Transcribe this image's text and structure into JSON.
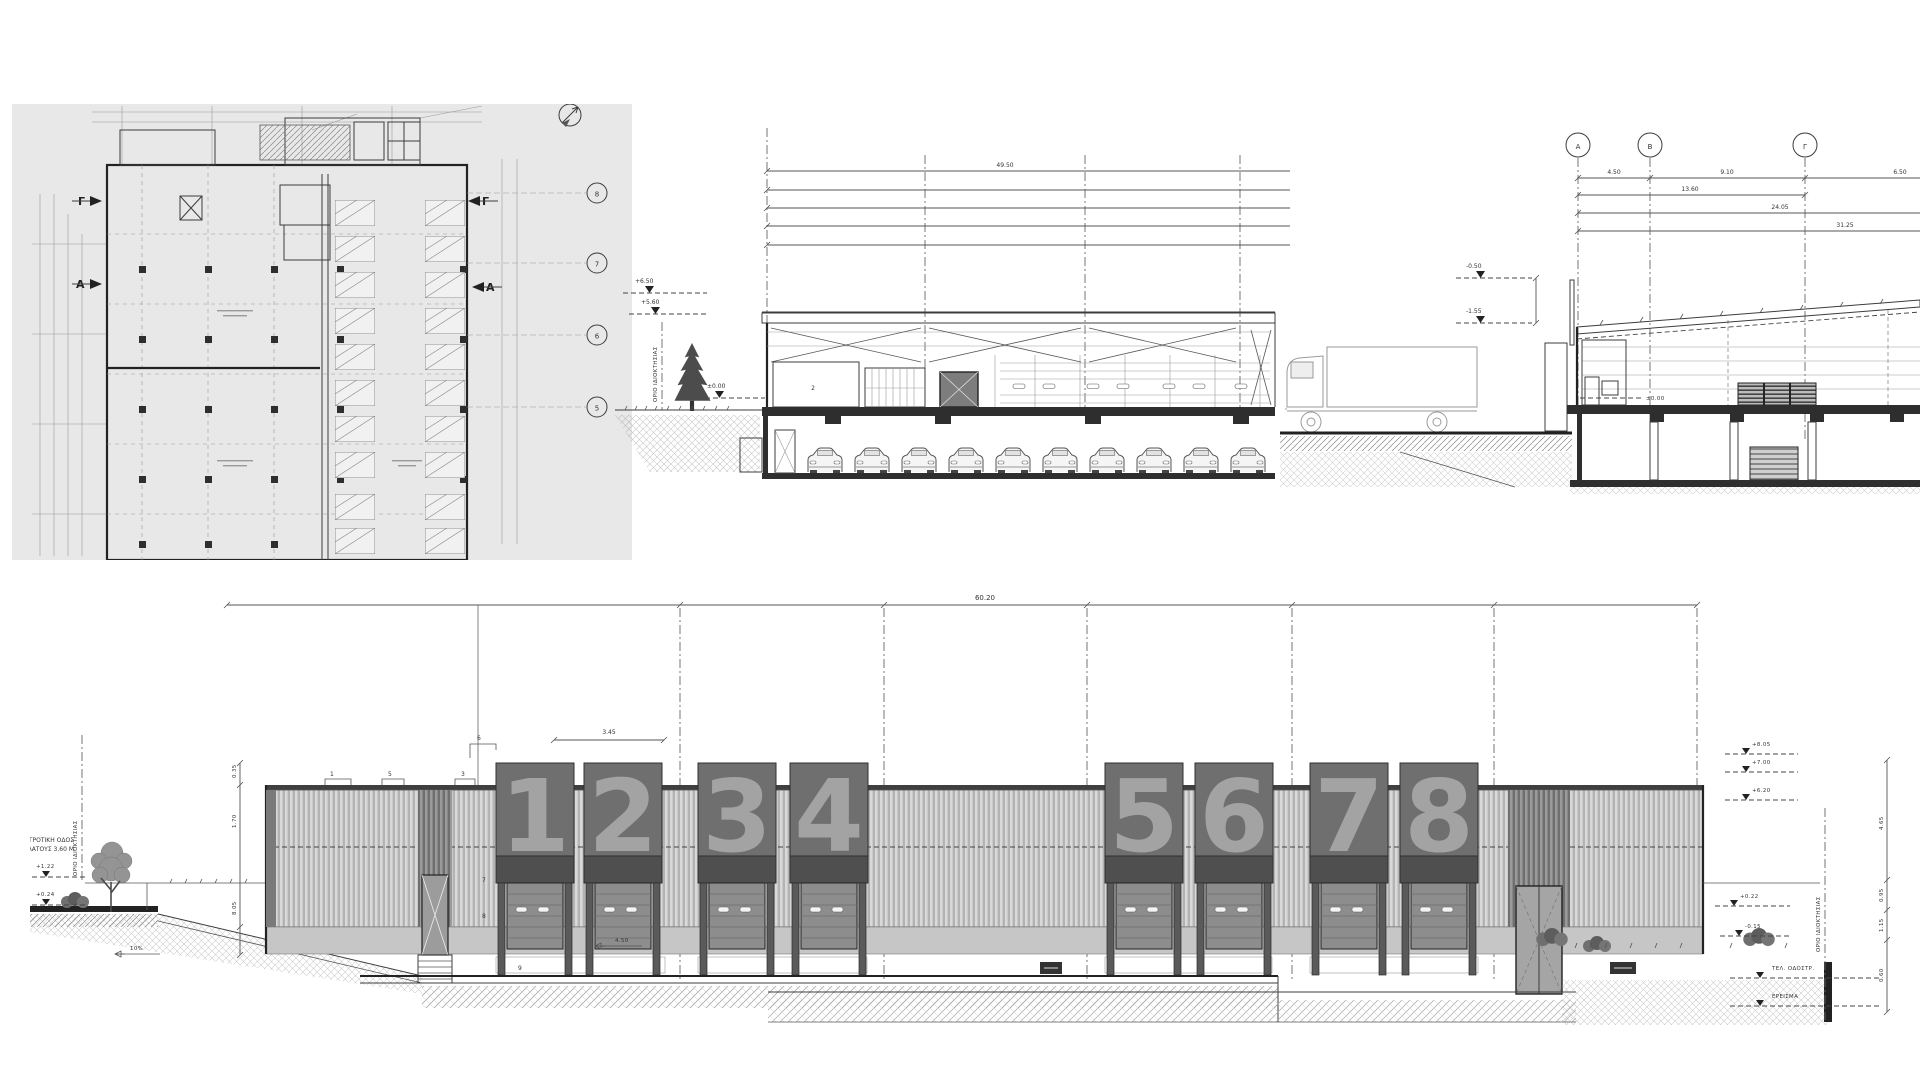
{
  "plan": {
    "bubbles": [
      "8",
      "7",
      "6",
      "5"
    ],
    "marker_g": "Γ",
    "marker_a": "Α"
  },
  "section_a": {
    "dim_top": "49.50",
    "levels": [
      "+6.50",
      "+5.60",
      "±0.00"
    ],
    "room": "2",
    "boundary": "ΟΡΙΟ ΙΔΙΟΚΤΗΣΙΑΣ"
  },
  "section_b": {
    "bubbles": [
      "Α",
      "Β",
      "Γ"
    ],
    "dims": [
      "4.50",
      "9.10",
      "6.50",
      "13.60",
      "24.05",
      "31.25"
    ],
    "levels": [
      "-0.50",
      "-1.55"
    ],
    "zero": "±0.00"
  },
  "elevation": {
    "overall": "60.20",
    "panels": [
      "1",
      "2",
      "3",
      "4",
      "5",
      "6",
      "7",
      "8"
    ],
    "dim_a": "3.45",
    "dim_b": "4.50",
    "keynotes": [
      "1",
      "5",
      "3",
      "6",
      "7",
      "8",
      "9"
    ],
    "road1": "ΑΓΡΟΤΙΚΗ ΟΔΟΣ",
    "road2": "ΠΛΑΤΟΥΣ 3.60 Μ",
    "boundary": "ΟΡΙΟ ΙΔΙΟΚΤΗΣΙΑΣ",
    "slope": "10%",
    "left_levels": [
      "+1.22",
      "+0.24"
    ],
    "left_dims": [
      "0.35",
      "1.70",
      "8.05"
    ],
    "right_levels": [
      "+8.05",
      "+7.00",
      "+6.20",
      "+0.22",
      "-0.15"
    ],
    "right_dims": [
      "4.65",
      "0.95",
      "1.15",
      "0.60"
    ],
    "right_notes": [
      "ΤΕΛ. ΟΔΟΣΤΡ.",
      "ΕΡΕΙΣΜΑ"
    ]
  },
  "colors": {
    "panel": "#6f6f6f",
    "digit": "#a8a8a8",
    "plan_bg": "#e8e8e8",
    "line": "#3c3c3c"
  }
}
